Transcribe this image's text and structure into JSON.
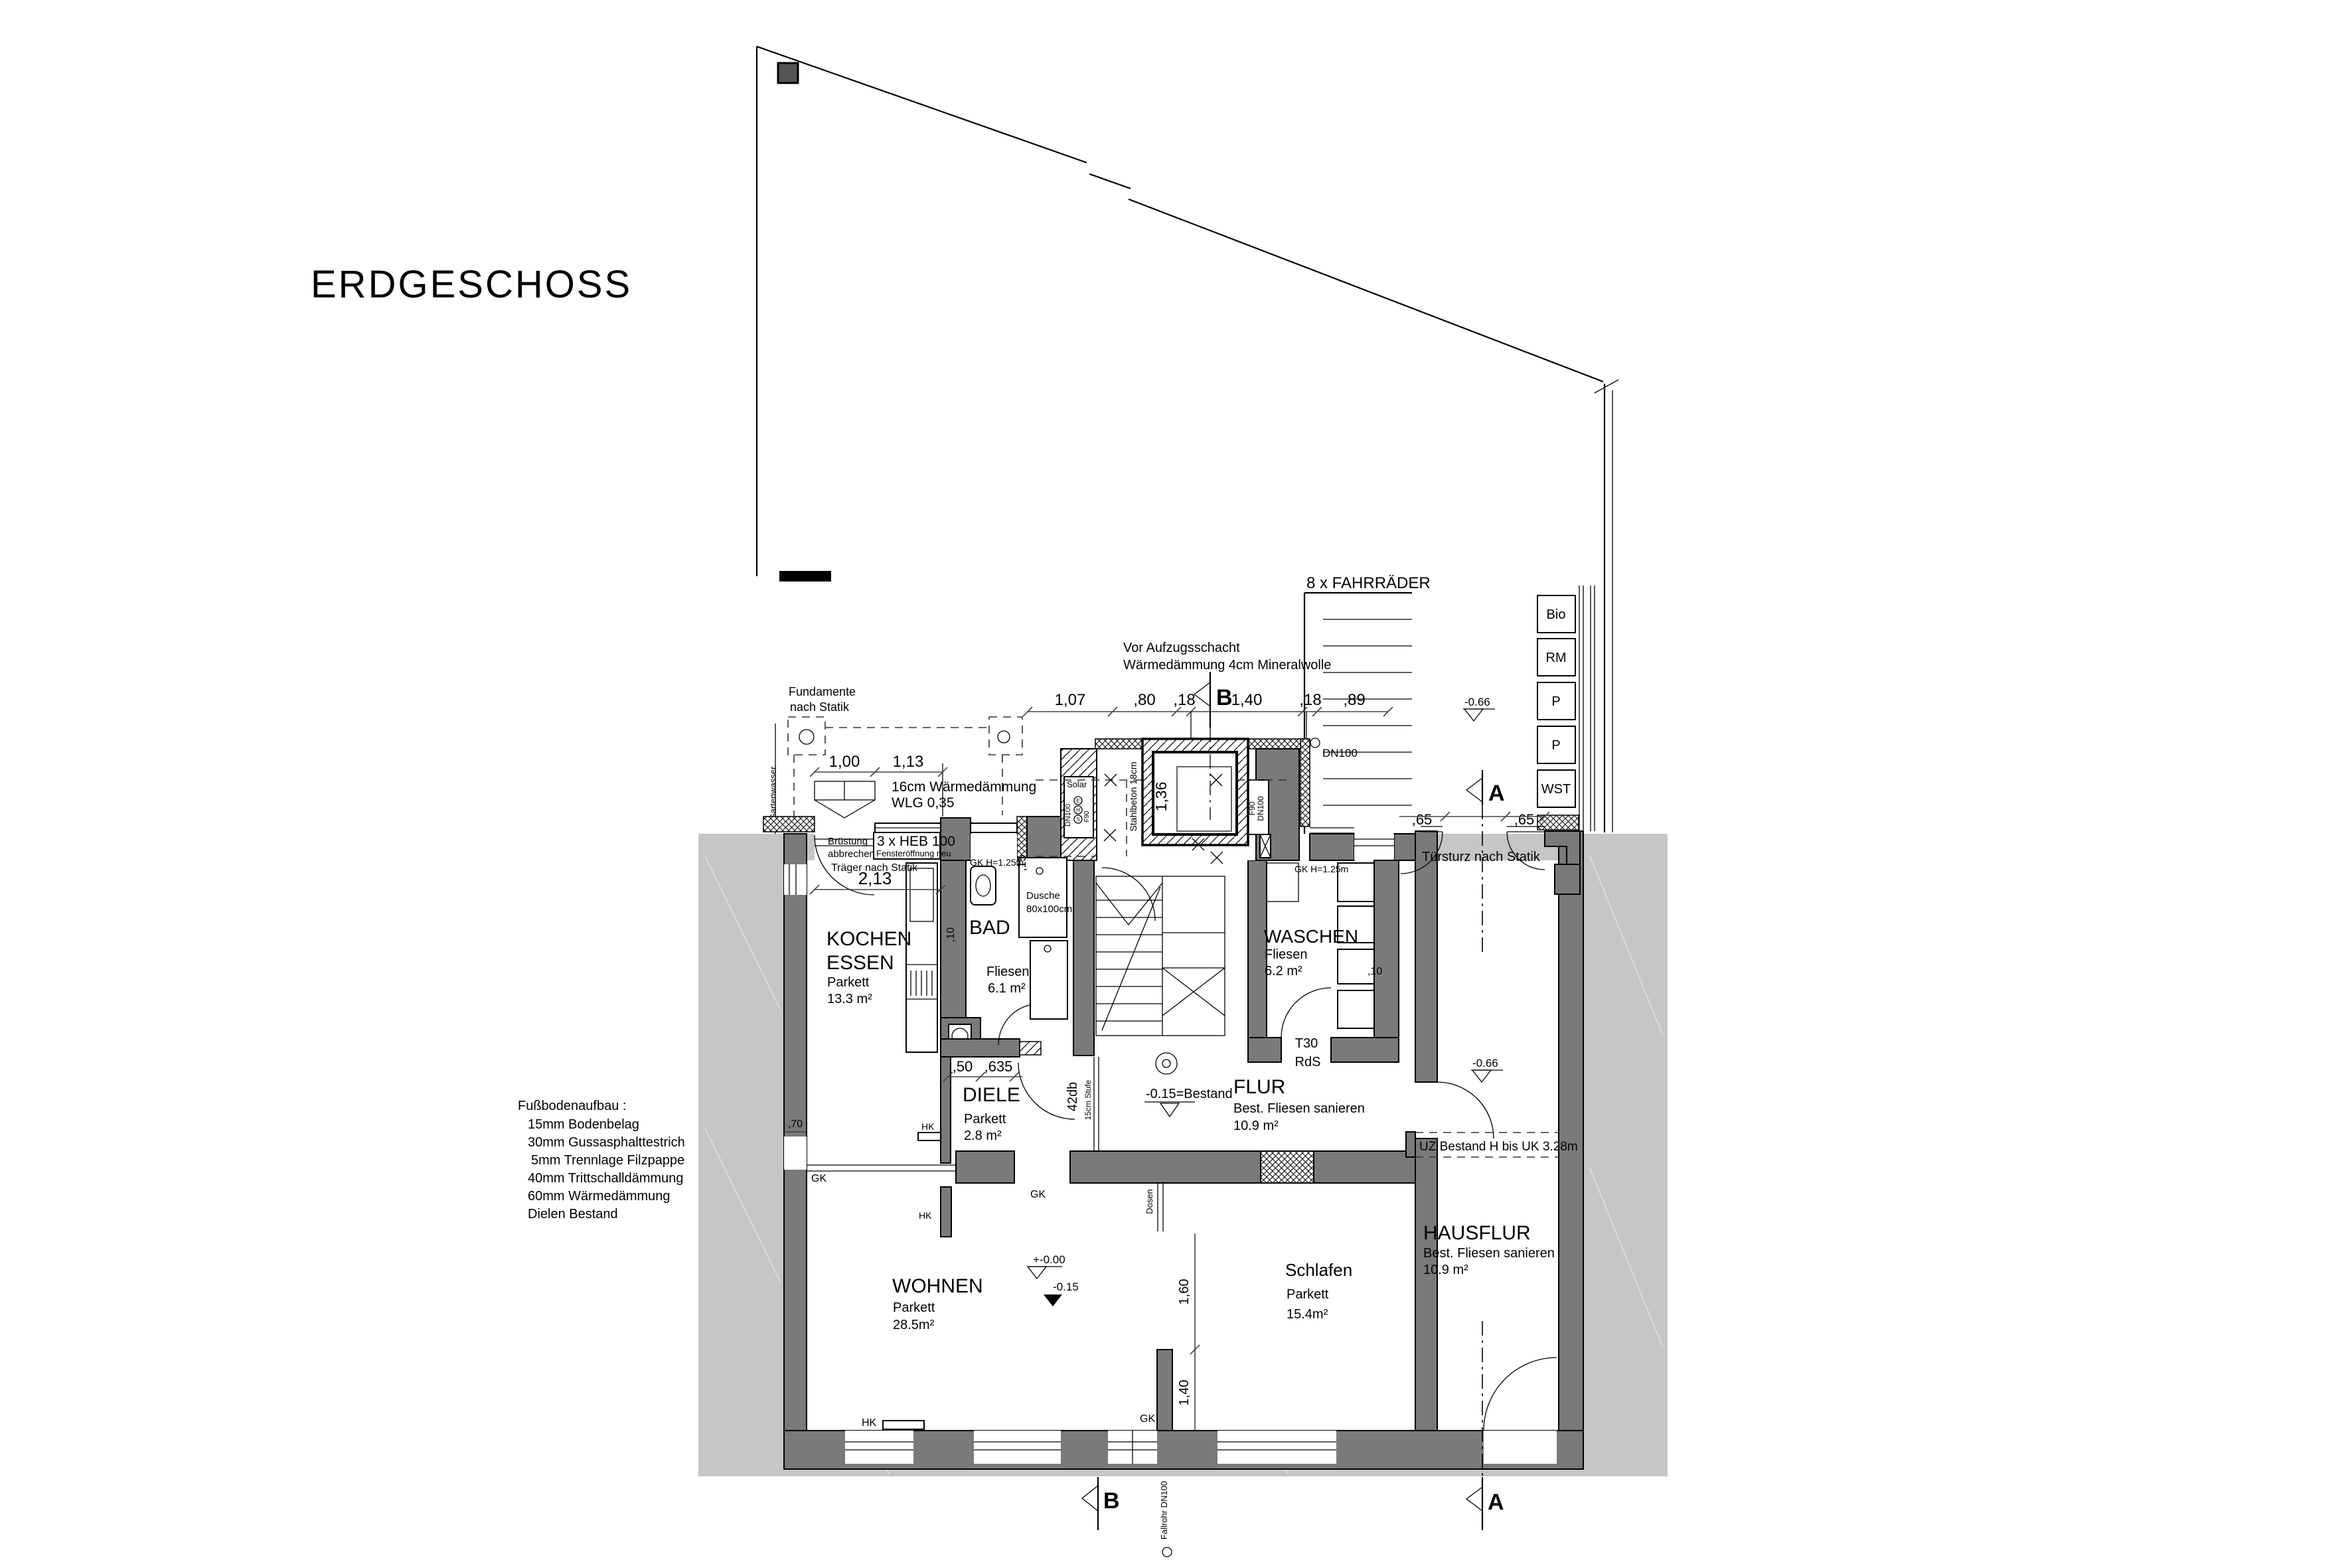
{
  "title": "ERDGESCHOSS",
  "legend": {
    "heading": "Fußbodenaufbau :",
    "lines": [
      "15mm Bodenbelag",
      "30mm Gussasphalttestrich",
      "5mm Trennlage Filzpappe",
      "40mm Trittschalldämmung",
      "60mm Wärmedämmung",
      "Dielen Bestand"
    ]
  },
  "rooms": {
    "kochen": {
      "name1": "KOCHEN",
      "name2": "ESSEN",
      "finish": "Parkett",
      "area": "13.3 m²"
    },
    "bad": {
      "name": "BAD",
      "finish": "Fliesen",
      "area": "6.1 m²"
    },
    "diele": {
      "name": "DIELE",
      "finish": "Parkett",
      "area": "2.8 m²"
    },
    "waschen": {
      "name": "WASCHEN",
      "finish": "Fliesen",
      "area": "6.2 m²"
    },
    "flur": {
      "name": "FLUR",
      "finish": "Best. Fliesen sanieren",
      "area": "10.9 m²"
    },
    "wohnen": {
      "name": "WOHNEN",
      "finish": "Parkett",
      "area": "28.5m²"
    },
    "schlafen": {
      "name": "Schlafen",
      "finish": "Parkett",
      "area": "15.4m²"
    },
    "hausflur": {
      "name": "HAUSFLUR",
      "finish": "Best. Fliesen sanieren",
      "area": "10.9 m²"
    }
  },
  "storage": [
    "Bio",
    "RM",
    "P",
    "P",
    "WST"
  ],
  "notes": {
    "fahrraeder": "8 x FAHRRÄDER",
    "aufzug1": "Vor Aufzugsschacht",
    "aufzug2": "Wärmedämmung 4cm Mineralwolle",
    "fundamente1": "Fundamente",
    "fundamente2": "nach Statik",
    "daemmung1": "16cm Wärmedämmung",
    "daemmung2": "WLG 0,35",
    "bruestung1": "Brüstung",
    "bruestung2": "abbrechen",
    "heb": "3 x HEB 100",
    "fenster": "Fensteröffnung neu",
    "traeger": "Träger nach Statik",
    "tuersturz": "Türsturz nach Statik",
    "uz": "UZ Bestand H bis UK 3.28m",
    "t30": "T30",
    "rds": "RdS",
    "gk_h": "GK H=1.25m",
    "dusche1": "Dusche",
    "dusche2": "80x100cm",
    "stahlbeton": "Stahlbeton 18cm",
    "gartenwasser": "Gartenwasser",
    "fallrohr": "Fallrohr DN100",
    "dosen": "Dosen",
    "db": "42db",
    "stufe": "15cm Stufe",
    "gk": "GK",
    "hk": "HK",
    "bestand": "-0.15=Bestand",
    "dn100_top": "DN100"
  },
  "riser": {
    "solar": "Solar",
    "dn100": "DN100",
    "f90": "F90",
    "letters": [
      "E",
      "H",
      "S"
    ]
  },
  "levels": {
    "zero": "+-0.00",
    "minus015": "-0.15",
    "minus066": "-0.66"
  },
  "dims": {
    "top_chain": [
      "1,07",
      ",80",
      ",18",
      "1,40",
      ",18",
      ",89"
    ],
    "court": [
      "1,00",
      "1,13"
    ],
    "d213": "2,13",
    "d50": ",50",
    "d635": ",635",
    "d65": ",65",
    "d136": "1,36",
    "d15": ",15",
    "d10": ",10",
    "d160": "1,60",
    "d140": "1,40",
    "d70": ",70"
  },
  "sections": {
    "a": "A",
    "b": "B"
  },
  "colors": {
    "wall": "#7a7a7a",
    "neighbor": "#c6c6c6",
    "paper": "#ffffff",
    "line": "#000000"
  }
}
